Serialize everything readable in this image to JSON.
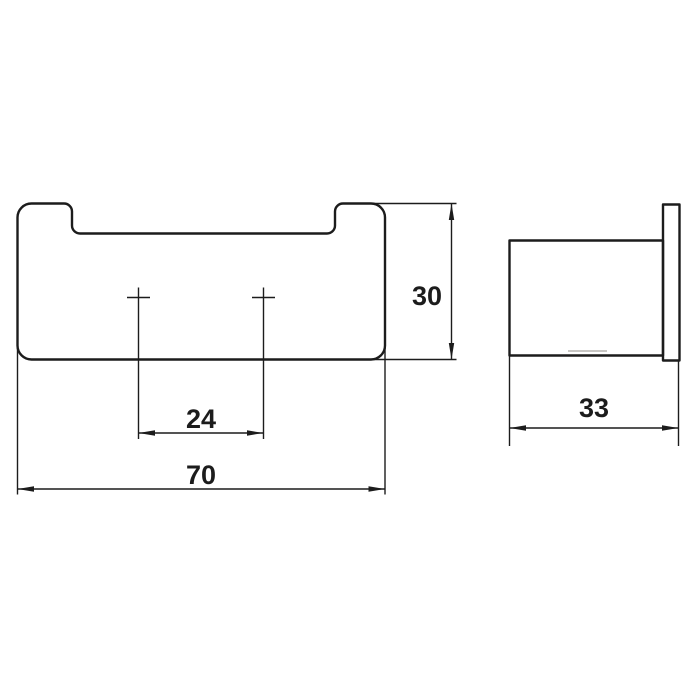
{
  "page": {
    "background_color": "#ffffff",
    "line_color": "#1c1c1c"
  },
  "drawing": {
    "kind": "technical-dimension-drawing",
    "views": {
      "front": {
        "dims": {
          "overall_width": "70",
          "overall_height": "30",
          "hole_spacing": "24"
        }
      },
      "side": {
        "dims": {
          "overall_depth": "33"
        }
      }
    }
  }
}
